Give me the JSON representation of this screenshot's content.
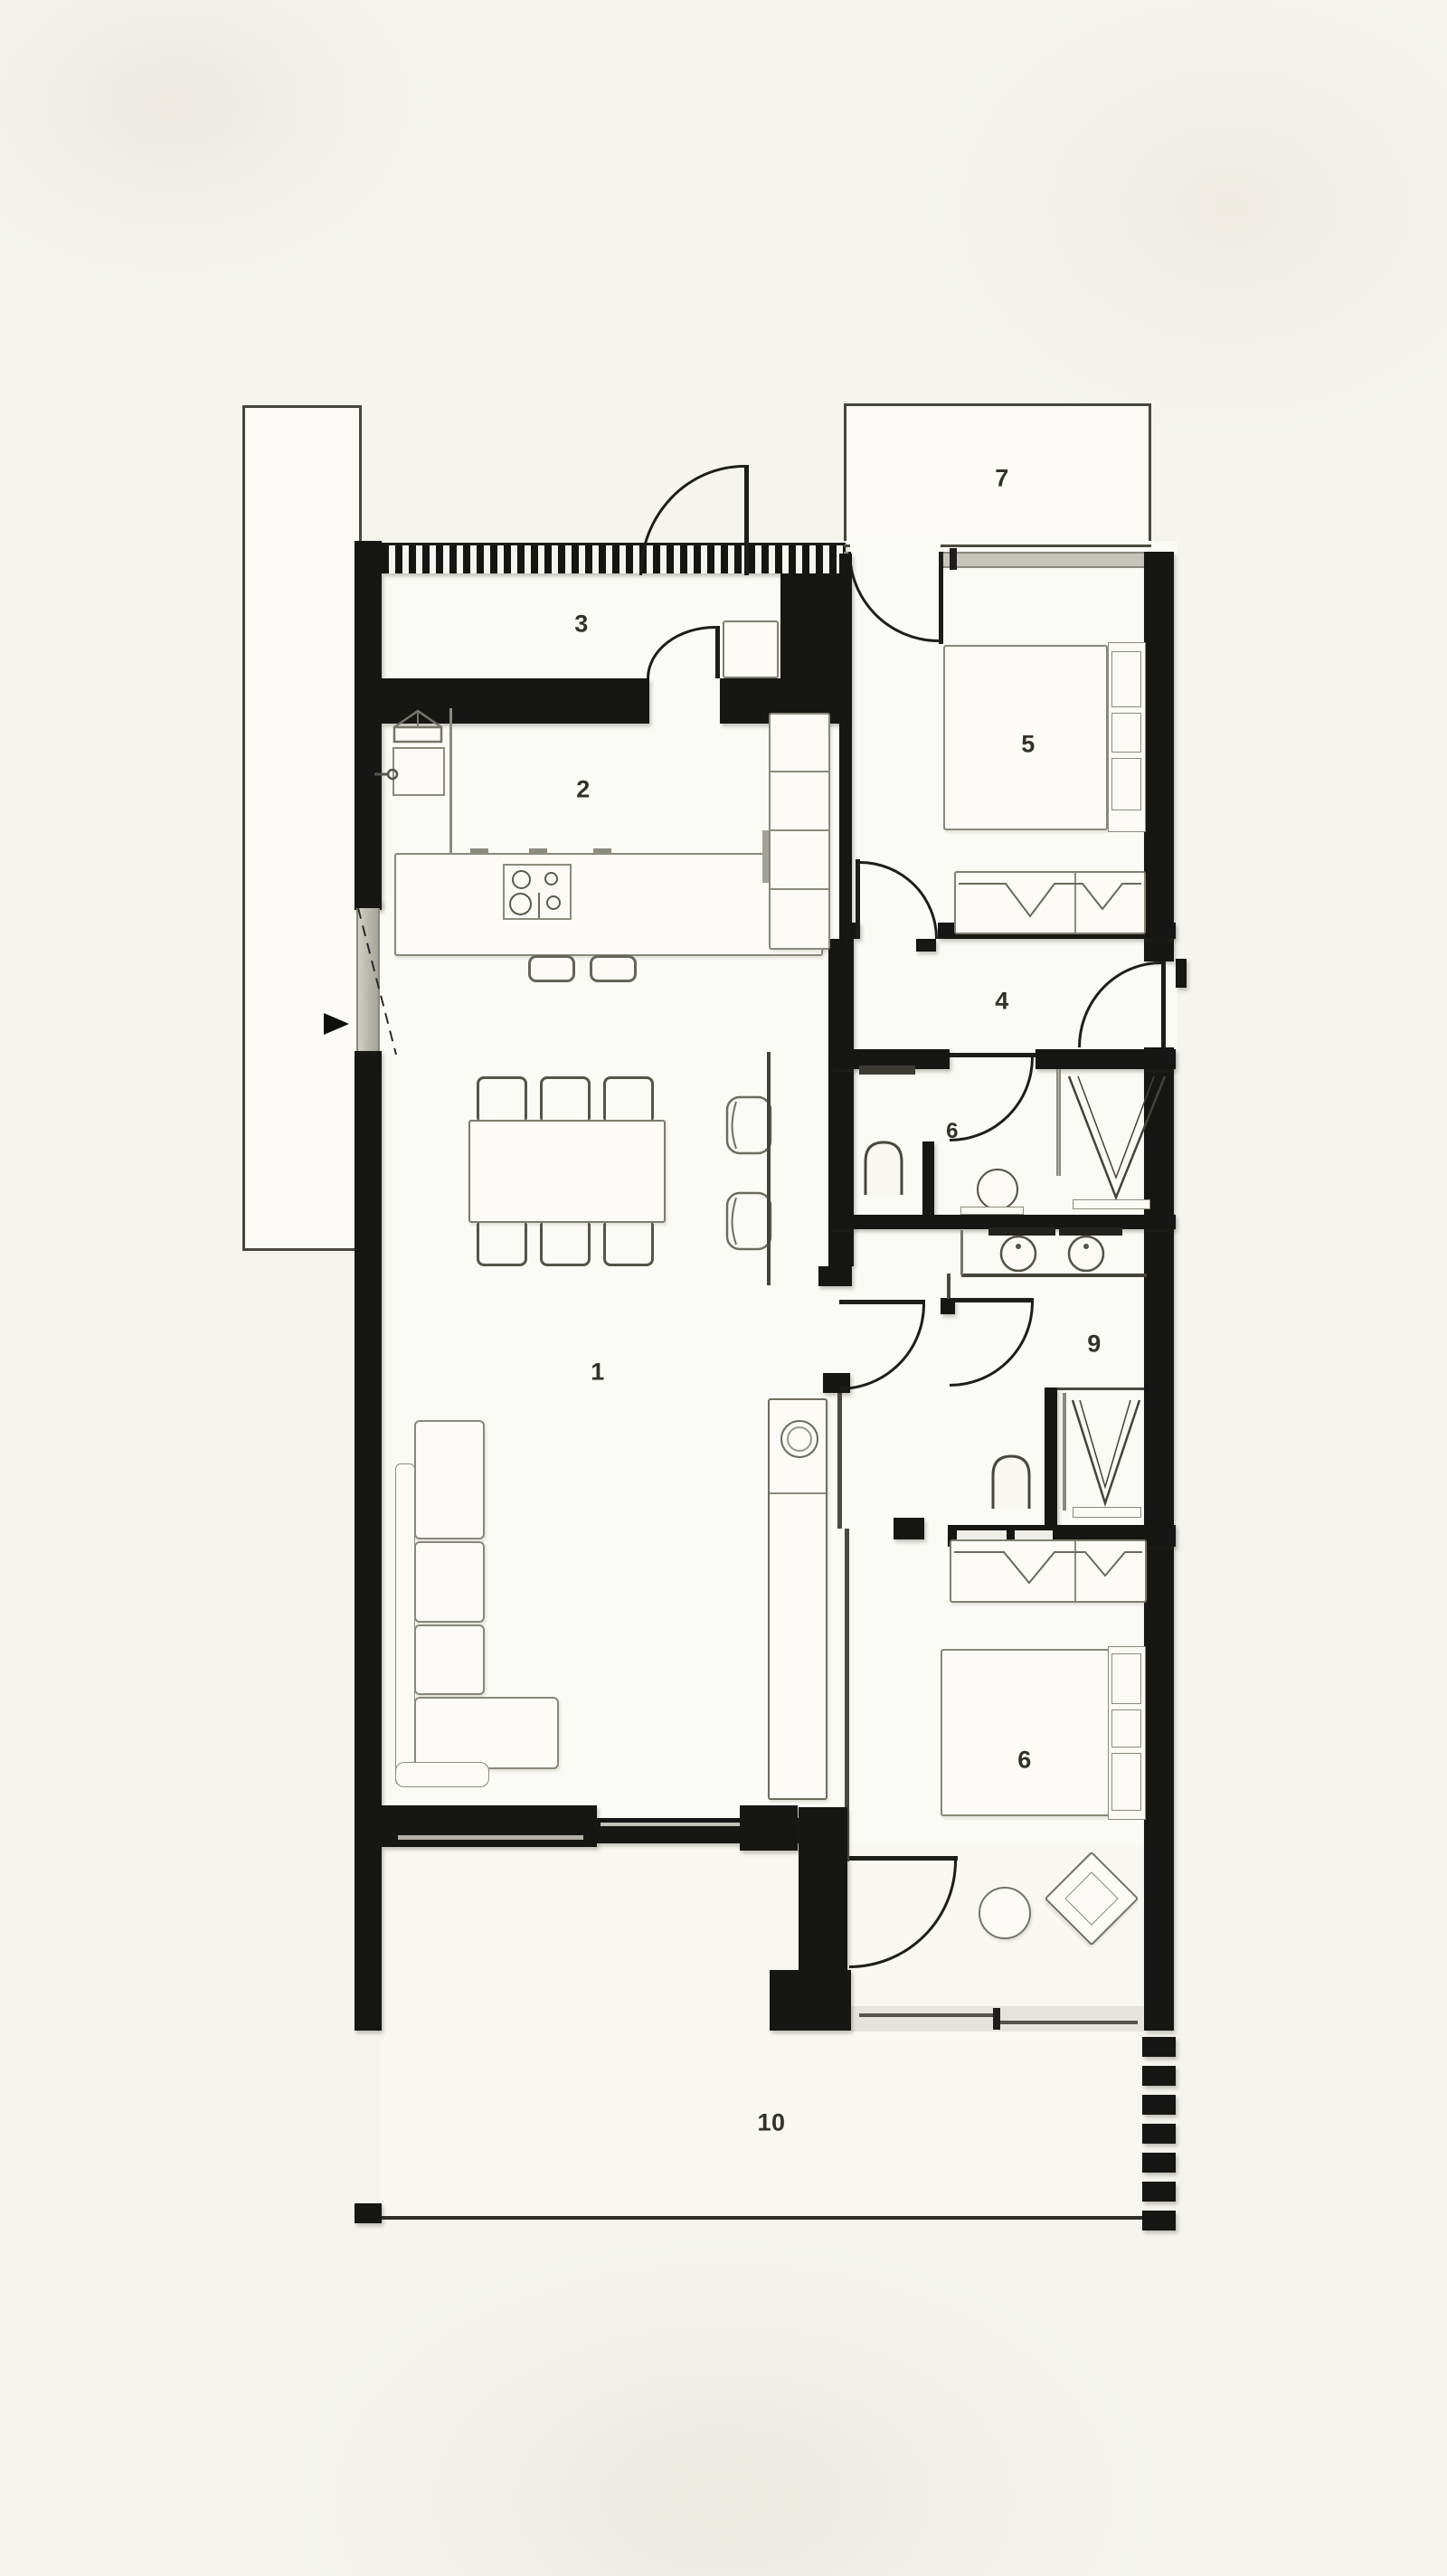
{
  "plan_title": "apartment-floor-plan",
  "palette": {
    "background": "#f5f4ef",
    "wall": "#161614",
    "floor": "#fafaf6",
    "furniture_stroke": "#817f72",
    "glass": "#c6c4bb",
    "label_color": "#33312a"
  },
  "rooms": [
    {
      "id": "living-room",
      "label": "1"
    },
    {
      "id": "kitchen",
      "label": "2"
    },
    {
      "id": "entry-hall",
      "label": "3"
    },
    {
      "id": "hallway",
      "label": "4"
    },
    {
      "id": "bedroom-main",
      "label": "5"
    },
    {
      "id": "bathroom-small",
      "label": "6"
    },
    {
      "id": "balcony-top",
      "label": "7"
    },
    {
      "id": "bathroom-main",
      "label": "9"
    },
    {
      "id": "bedroom-second",
      "label": "6"
    },
    {
      "id": "terrace",
      "label": "10"
    }
  ]
}
